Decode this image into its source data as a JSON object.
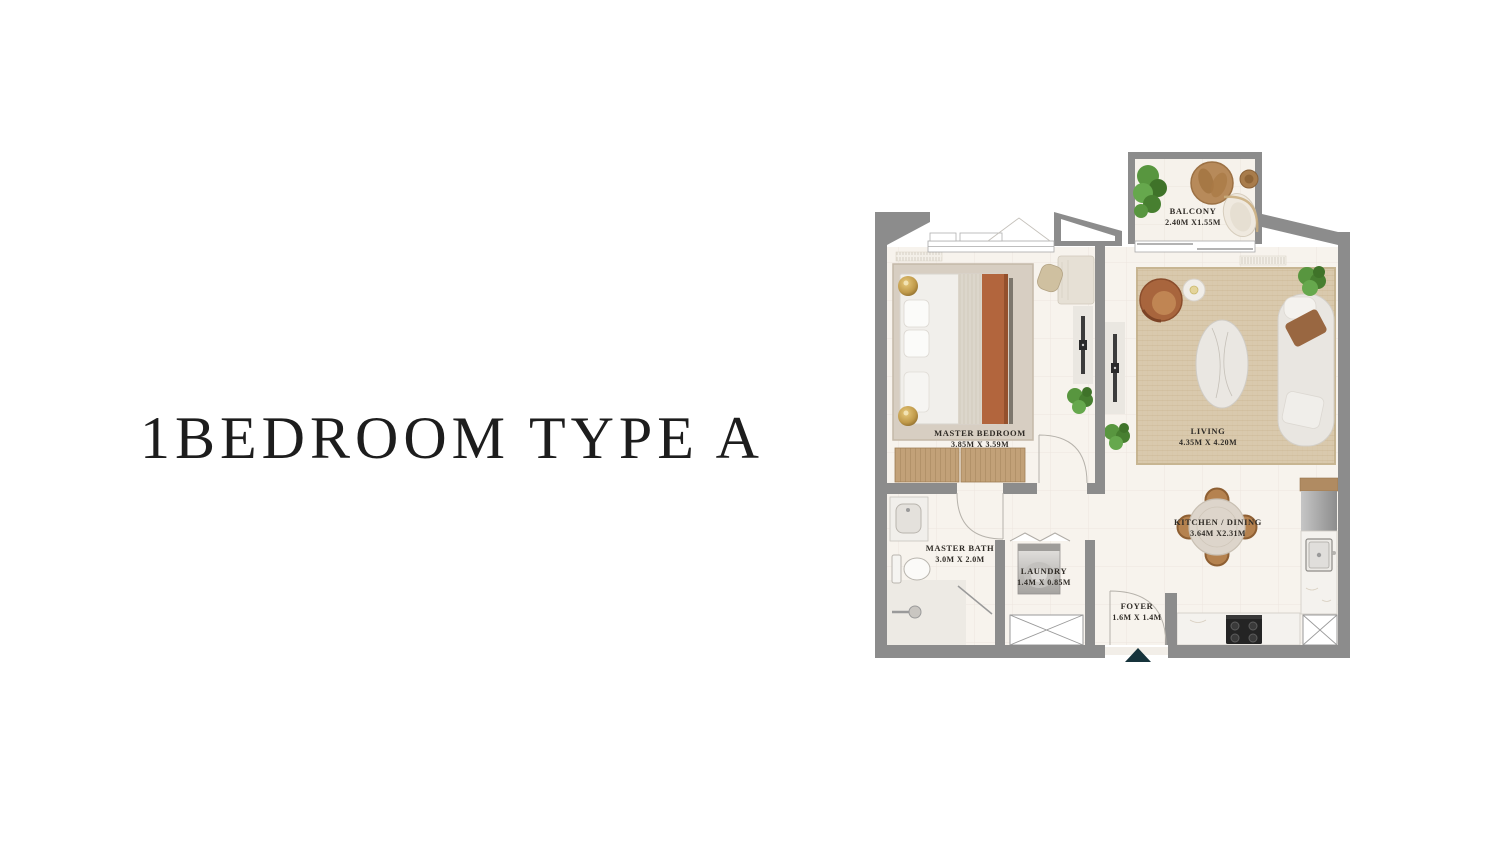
{
  "title": "1BEDROOM TYPE A",
  "floor_plan": {
    "rooms": {
      "balcony": {
        "name": "BALCONY",
        "dims": "2.40M X1.55M"
      },
      "master_bedroom": {
        "name": "MASTER BEDROOM",
        "dims": "3.85M X 3.59M"
      },
      "living": {
        "name": "LIVING",
        "dims": "4.35M X 4.20M"
      },
      "kitchen_dining": {
        "name": "KITCHEN / DINING",
        "dims": "3.64M X2.31M"
      },
      "master_bath": {
        "name": "MASTER BATH",
        "dims": "3.0M X 2.0M"
      },
      "laundry": {
        "name": "LAUNDRY",
        "dims": "1.4M X 0.85M"
      },
      "foyer": {
        "name": "FOYER",
        "dims": "1.6M X 1.4M"
      }
    },
    "colors": {
      "wall": "#8c8c8c",
      "floor": "#f7f3ed",
      "living_rug": "#d9c9ad",
      "bedroom_rug": "#d7cec2",
      "wood": "#c2a178",
      "plant_green": "#4f923d",
      "accent_rust": "#b2653d",
      "entrance_marker": "#16333b",
      "label_text": "#2f2b26"
    }
  }
}
